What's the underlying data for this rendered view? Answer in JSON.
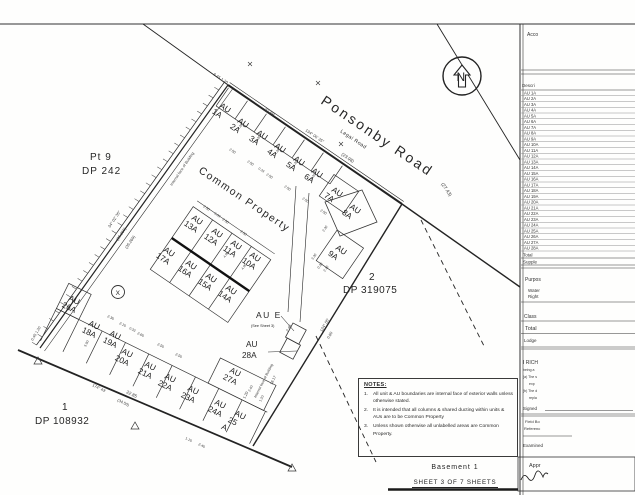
{
  "colors": {
    "ink": "#222222",
    "paper": "#fefefd"
  },
  "footer": {
    "title": "Basement 1",
    "sheet": "SHEET 3 OF 7 SHEETS"
  },
  "north_arrow": {
    "label": "N"
  },
  "notes": {
    "title": "NOTES:",
    "items": [
      "All unit & AU boundaries are internal face of exterior walls unless otherwise stated.",
      "It is intended that all columns & shared ducting within units & AUs are to be Common Property",
      "Unless shown otherwise all unlabelled areas are Common Property."
    ]
  },
  "map_labels": [
    {
      "t": "Ponsonby Road",
      "x": 320,
      "y": 103,
      "r": 34,
      "s": 14,
      "sp": 2.5
    },
    {
      "t": "Legal Road",
      "x": 340,
      "y": 132,
      "r": 34,
      "s": 5,
      "sp": 0.5
    },
    {
      "t": "Pt 9",
      "x": 90,
      "y": 160,
      "s": 10,
      "sp": 1
    },
    {
      "t": "DP 242",
      "x": 82,
      "y": 174,
      "s": 10,
      "sp": 1
    },
    {
      "t": "2",
      "x": 369,
      "y": 280,
      "s": 10
    },
    {
      "t": "DP 319075",
      "x": 343,
      "y": 293,
      "s": 10,
      "sp": 0.5
    },
    {
      "t": "1",
      "x": 62,
      "y": 410,
      "s": 10
    },
    {
      "t": "DP 108932",
      "x": 35,
      "y": 424,
      "s": 10,
      "sp": 0.5
    },
    {
      "t": "Common Property",
      "x": 198,
      "y": 172,
      "r": 34,
      "s": 10.5,
      "sp": 1.5
    },
    {
      "t": "AU E",
      "x": 256,
      "y": 318,
      "s": 8.5,
      "sp": 1.5
    },
    {
      "t": "(See Sheet 3)",
      "x": 251,
      "y": 327,
      "s": 3.8
    },
    {
      "t": "AU",
      "x": 246,
      "y": 347,
      "s": 8.2
    },
    {
      "t": "28A",
      "x": 242,
      "y": 358,
      "s": 8.2
    },
    {
      "t": "N",
      "x": 456.5,
      "y": 81,
      "s": 12
    },
    {
      "t": "X",
      "x": 115.6,
      "y": 294.8,
      "s": 6.5
    }
  ],
  "units": {
    "prefix": "AU",
    "labels": [
      {
        "id": "1A",
        "x": 219,
        "y": 107,
        "r": 34
      },
      {
        "id": "2A",
        "x": 237,
        "y": 122,
        "r": 34
      },
      {
        "id": "3A",
        "x": 256,
        "y": 134,
        "r": 34
      },
      {
        "id": "4A",
        "x": 274,
        "y": 147,
        "r": 34
      },
      {
        "id": "5A",
        "x": 293,
        "y": 160,
        "r": 34
      },
      {
        "id": "6A",
        "x": 311,
        "y": 172,
        "r": 34
      },
      {
        "id": "7A",
        "x": 331,
        "y": 191,
        "r": 34
      },
      {
        "id": "8A",
        "x": 349,
        "y": 208,
        "r": 34
      },
      {
        "id": "9A",
        "x": 335,
        "y": 249,
        "r": 34
      },
      {
        "id": "10A",
        "x": 249,
        "y": 256,
        "r": 34
      },
      {
        "id": "11A",
        "x": 230,
        "y": 244,
        "r": 34
      },
      {
        "id": "12A",
        "x": 211,
        "y": 232,
        "r": 34
      },
      {
        "id": "13A",
        "x": 191,
        "y": 219,
        "r": 34
      },
      {
        "id": "14A",
        "x": 225,
        "y": 289,
        "r": 34
      },
      {
        "id": "15A",
        "x": 205,
        "y": 277,
        "r": 34
      },
      {
        "id": "16A",
        "x": 185,
        "y": 264,
        "r": 34
      },
      {
        "id": "17A",
        "x": 163,
        "y": 251,
        "r": 34
      },
      {
        "id": "18A",
        "x": 88,
        "y": 325,
        "r": 26
      },
      {
        "id": "19A",
        "x": 109,
        "y": 335,
        "r": 26
      },
      {
        "id": "20A",
        "x": 121,
        "y": 353,
        "r": 26
      },
      {
        "id": "21A",
        "x": 144,
        "y": 366,
        "r": 26
      },
      {
        "id": "22A",
        "x": 164,
        "y": 378,
        "r": 26
      },
      {
        "id": "23A",
        "x": 187,
        "y": 390,
        "r": 26
      },
      {
        "id": "24A",
        "x": 214,
        "y": 404,
        "r": 26
      },
      {
        "id": "25A",
        "x": 234,
        "y": 415,
        "r": 26,
        "lines": [
          "AU",
          "25",
          "A"
        ]
      },
      {
        "id": "26A",
        "x": 68,
        "y": 300,
        "r": 26
      },
      {
        "id": "27A",
        "x": 229,
        "y": 372,
        "r": 26
      }
    ]
  },
  "dims": [
    {
      "t": "6.45 1.20",
      "x": 213,
      "y": 75,
      "r": 33
    },
    {
      "t": "22.89",
      "x": 264,
      "y": 110,
      "r": 34,
      "s": 4.5
    },
    {
      "t": "134° 06' 35\"",
      "x": 305,
      "y": 131,
      "r": 34
    },
    {
      "t": "(23.98)",
      "x": 341,
      "y": 155,
      "r": 34,
      "s": 4.5
    },
    {
      "t": "(27.43)",
      "x": 441,
      "y": 184,
      "r": 56,
      "s": 4.8
    },
    {
      "t": "34° 02' 35\"",
      "x": 110,
      "y": 228,
      "r": -56
    },
    {
      "t": "(35.269)",
      "x": 118,
      "y": 241,
      "r": -56
    },
    {
      "t": "(35.269)",
      "x": 127,
      "y": 249,
      "r": -56
    },
    {
      "t": "Internal face of Building",
      "x": 172,
      "y": 186,
      "r": -56,
      "s": 3.8
    },
    {
      "t": "174° 43'",
      "x": 92,
      "y": 386,
      "r": 26
    },
    {
      "t": "22.85",
      "x": 126,
      "y": 393,
      "r": 26,
      "s": 4.5
    },
    {
      "t": "(34.50)",
      "x": 117,
      "y": 401,
      "r": 26
    },
    {
      "t": "0.45 1.20",
      "x": 33,
      "y": 341,
      "r": -60,
      "s": 3.8
    },
    {
      "t": "124° 05'",
      "x": 322,
      "y": 332,
      "r": -60
    },
    {
      "t": "0.60",
      "x": 329,
      "y": 339,
      "r": -60,
      "s": 3.8
    },
    {
      "t": "2.40",
      "x": 288,
      "y": 332,
      "r": -60,
      "s": 3.8
    },
    {
      "t": "18.17",
      "x": 272,
      "y": 385,
      "r": -63,
      "s": 3.8
    },
    {
      "t": "1.20",
      "x": 245,
      "y": 399,
      "r": -63,
      "s": 3.8
    },
    {
      "t": "Internal face of Building",
      "x": 256,
      "y": 398,
      "r": -63,
      "s": 3.6
    },
    {
      "t": "2.50",
      "x": 229,
      "y": 150,
      "r": 34,
      "s": 3.6
    },
    {
      "t": "2.50",
      "x": 247,
      "y": 162,
      "r": 34,
      "s": 3.6
    },
    {
      "t": "0.33",
      "x": 258,
      "y": 169,
      "r": 34,
      "s": 3.4
    },
    {
      "t": "2.50",
      "x": 266,
      "y": 175,
      "r": 34,
      "s": 3.6
    },
    {
      "t": "2.50",
      "x": 284,
      "y": 187,
      "r": 34,
      "s": 3.6
    },
    {
      "t": "2.50",
      "x": 302,
      "y": 199,
      "r": 34,
      "s": 3.6
    },
    {
      "t": "2.50",
      "x": 320,
      "y": 211,
      "r": 34,
      "s": 3.6
    },
    {
      "t": "4.20",
      "x": 239,
      "y": 130,
      "r": -56,
      "s": 3.4
    },
    {
      "t": "4.20",
      "x": 257,
      "y": 142,
      "r": -56,
      "s": 3.4
    },
    {
      "t": "4.20",
      "x": 276,
      "y": 155,
      "r": -56,
      "s": 3.4
    },
    {
      "t": "4.20",
      "x": 294,
      "y": 167,
      "r": -56,
      "s": 3.4
    },
    {
      "t": "4.20",
      "x": 312,
      "y": 180,
      "r": -56,
      "s": 3.4
    },
    {
      "t": "2.50",
      "x": 203,
      "y": 207,
      "r": 34,
      "s": 3.6
    },
    {
      "t": "0.33",
      "x": 214,
      "y": 214,
      "r": 34,
      "s": 3.4
    },
    {
      "t": "2.50",
      "x": 222,
      "y": 220,
      "r": 34,
      "s": 3.6
    },
    {
      "t": "2.50",
      "x": 240,
      "y": 232,
      "r": 34,
      "s": 3.6
    },
    {
      "t": "4.90",
      "x": 225,
      "y": 258,
      "r": -56,
      "s": 3.4
    },
    {
      "t": "4.90",
      "x": 243,
      "y": 270,
      "r": -56,
      "s": 3.4
    },
    {
      "t": "2.30",
      "x": 324,
      "y": 232,
      "r": -56,
      "s": 3.4
    },
    {
      "t": "2.10",
      "x": 325,
      "y": 272,
      "r": -56,
      "s": 3.4
    },
    {
      "t": "3.30",
      "x": 313,
      "y": 260,
      "r": -56,
      "s": 3.4
    },
    {
      "t": "0.20",
      "x": 319,
      "y": 269,
      "r": -56,
      "s": 3.4
    },
    {
      "t": "2.30",
      "x": 107,
      "y": 317,
      "r": 26,
      "s": 3.6
    },
    {
      "t": "2.10",
      "x": 119,
      "y": 324,
      "r": 26,
      "s": 3.6
    },
    {
      "t": "0.33",
      "x": 129,
      "y": 329,
      "r": 26,
      "s": 3.4
    },
    {
      "t": "2.60",
      "x": 137,
      "y": 334,
      "r": 26,
      "s": 3.6
    },
    {
      "t": "2.50",
      "x": 157,
      "y": 345,
      "r": 26,
      "s": 3.6
    },
    {
      "t": "2.50",
      "x": 175,
      "y": 355,
      "r": 26,
      "s": 3.6
    },
    {
      "t": "1.10",
      "x": 185,
      "y": 439,
      "r": 26,
      "s": 3.6
    },
    {
      "t": "2.40",
      "x": 198,
      "y": 445,
      "r": 26,
      "s": 3.6
    },
    {
      "t": "5.90",
      "x": 86,
      "y": 347,
      "r": -64,
      "s": 3.4
    },
    {
      "t": "2.40",
      "x": 250,
      "y": 392,
      "r": -63,
      "s": 3.4
    },
    {
      "t": "1.20",
      "x": 261,
      "y": 402,
      "r": -63,
      "s": 3.4
    }
  ],
  "sidebar": {
    "rows": [
      "AU 1A",
      "AU 2A",
      "AU 3A",
      "AU 4A",
      "AU 5A",
      "AU 6A",
      "AU 7A",
      "AU 8A",
      "AU 9A",
      "AU 10A",
      "AU 11A",
      "AU 12A",
      "AU 13A",
      "AU 14A",
      "AU 15A",
      "AU 16A",
      "AU 17A",
      "AU 18A",
      "AU 19A",
      "AU 20A",
      "AU 21A",
      "AU 22A",
      "AU 23A",
      "AU 24A",
      "AU 25A",
      "AU 26A",
      "AU 27A",
      "AU 28A"
    ],
    "labels": [
      {
        "t": "Acco",
        "x": 527,
        "y": 36,
        "s": 5
      },
      {
        "t": "Descri",
        "x": 522,
        "y": 87,
        "s": 4.5
      },
      {
        "t": "Total",
        "x": 523,
        "y": 256.5,
        "s": 4.5
      },
      {
        "t": "Supple",
        "x": 523,
        "y": 263.5,
        "s": 4.5
      },
      {
        "t": "Purpos",
        "x": 525,
        "y": 281,
        "s": 5
      },
      {
        "t": "Water",
        "x": 528,
        "y": 292,
        "s": 4.5
      },
      {
        "t": "Right",
        "x": 528,
        "y": 298,
        "s": 4.5
      },
      {
        "t": "Class",
        "x": 524,
        "y": 318,
        "s": 5
      },
      {
        "t": "Total",
        "x": 525,
        "y": 330,
        "s": 5.5
      },
      {
        "t": "Lodge",
        "x": 524,
        "y": 342,
        "s": 4.5
      },
      {
        "t": "I RICH",
        "x": 523,
        "y": 364,
        "s": 5
      },
      {
        "t": "being a",
        "x": 523,
        "y": 371,
        "s": 3.5
      },
      {
        "t": "(a) The s",
        "x": 523,
        "y": 378,
        "s": 3.5
      },
      {
        "t": "exp",
        "x": 529,
        "y": 385,
        "s": 3.5
      },
      {
        "t": "(b) The d",
        "x": 523,
        "y": 392,
        "s": 3.5
      },
      {
        "t": "repla",
        "x": 529,
        "y": 399,
        "s": 3.5
      },
      {
        "t": "Signed",
        "x": 523,
        "y": 410,
        "s": 4.5
      },
      {
        "t": "Field Bo",
        "x": 525,
        "y": 423,
        "s": 4
      },
      {
        "t": "Referenc",
        "x": 524,
        "y": 430,
        "s": 4
      },
      {
        "t": "Examined",
        "x": 523,
        "y": 447,
        "s": 4.5
      },
      {
        "t": "Appr",
        "x": 529,
        "y": 467,
        "s": 5.5
      }
    ]
  }
}
